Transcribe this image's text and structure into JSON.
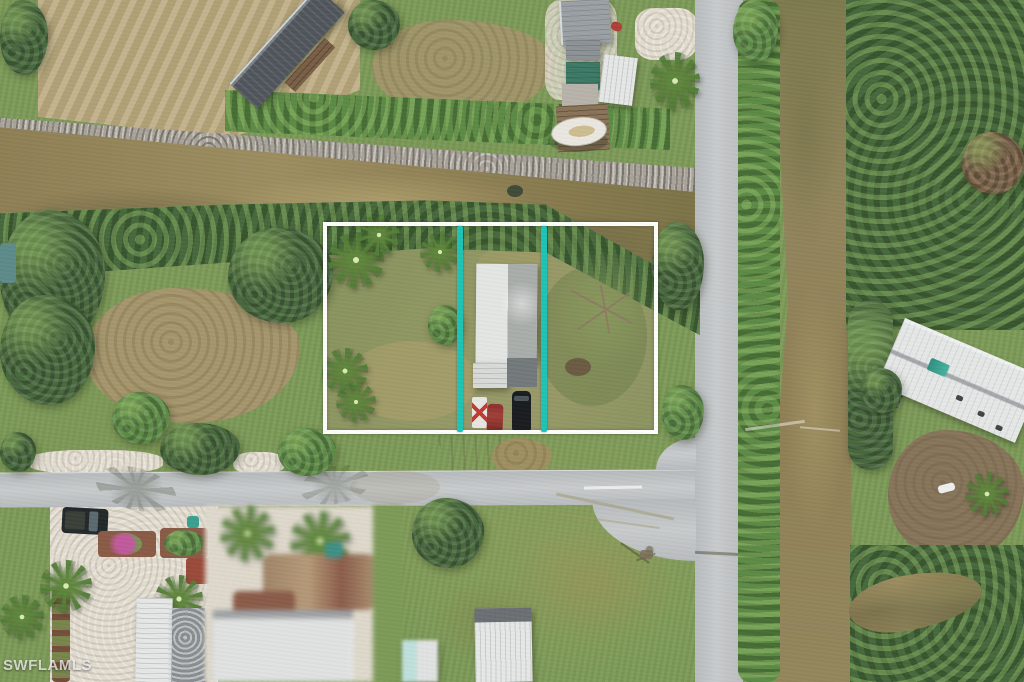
{
  "meta": {
    "kind": "aerial-photograph",
    "width_px": 1024,
    "height_px": 682,
    "subject": "Drone aerial view of a vacant waterfront lot marked with a property boundary overlay"
  },
  "watermark": {
    "text": "SWFLAMLS"
  },
  "overlay": {
    "boundary": {
      "shape": "rectangle",
      "color_key": "boundary_white"
    },
    "dividers": {
      "count": 2,
      "orientation": "vertical",
      "color_key": "divider_teal"
    }
  },
  "scene": {
    "features": [
      "horizontal canal with muddy water",
      "vertical canal along right side",
      "paved road T-intersection",
      "outlined lot containing metal-roof mobile home",
      "two teal lot-division lines",
      "mangrove tree lines along canals",
      "palm trees",
      "wooden dock with boat",
      "black SUV, red car and white trailer parked in lot",
      "tilted white metal-roof house with teal skylight on right",
      "blurred neighboring trailer-park property",
      "dry mowed field top-left",
      "shell gravel drives and planters bottom-left",
      "utility pole with shadow at intersection"
    ],
    "palette": {
      "grass": "#7c9a57",
      "trees_dark": "#47683c",
      "trees_bright": "#5d8a46",
      "water": "#8f7f55",
      "road": "#c8cbcc",
      "gravel": "#e2dccf",
      "dirt": "#a5966c",
      "dry_field": "#b9a87c",
      "roof_white": "#e6e8e8",
      "roof_gray": "#9aa0a4",
      "roof_dark": "#4e545a",
      "roof_teal": "#3c7a66",
      "boundary_white": "#fdfdfb",
      "divider_teal": "#1ec3b7"
    }
  }
}
